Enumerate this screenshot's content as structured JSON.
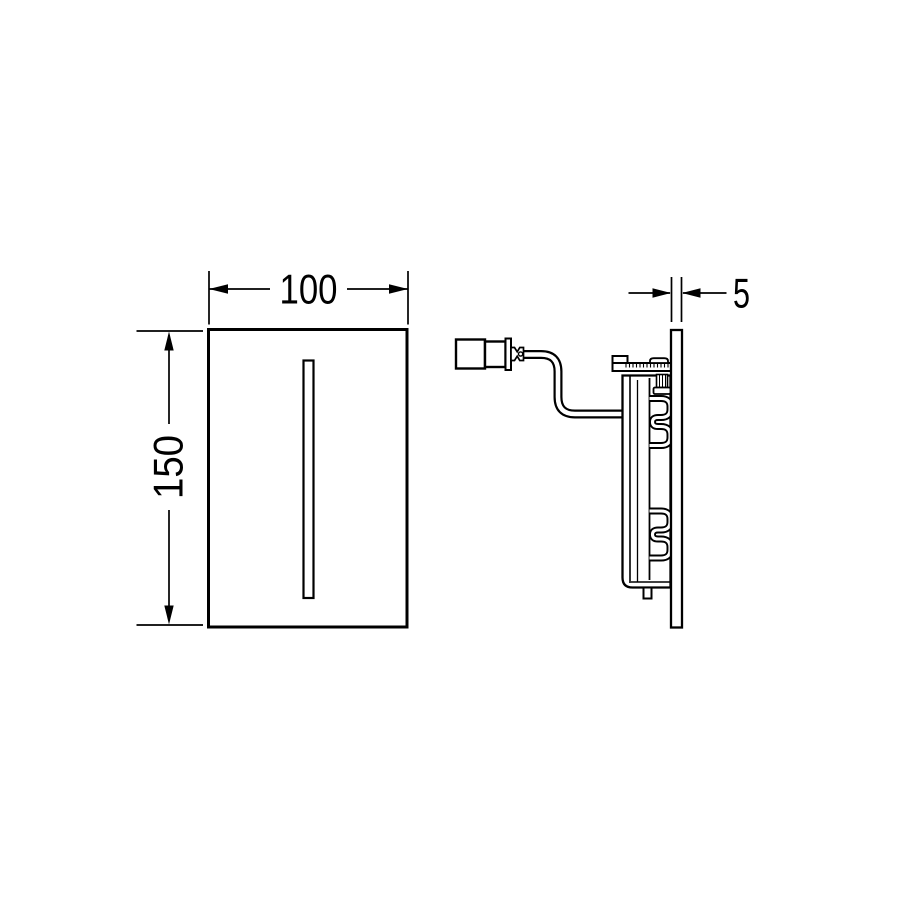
{
  "page": {
    "background": "#ffffff"
  },
  "drawing": {
    "line_color": "#000000",
    "front_view": {
      "width_label": "100",
      "height_label": "150"
    },
    "side_view": {
      "thickness_label": "5"
    }
  }
}
